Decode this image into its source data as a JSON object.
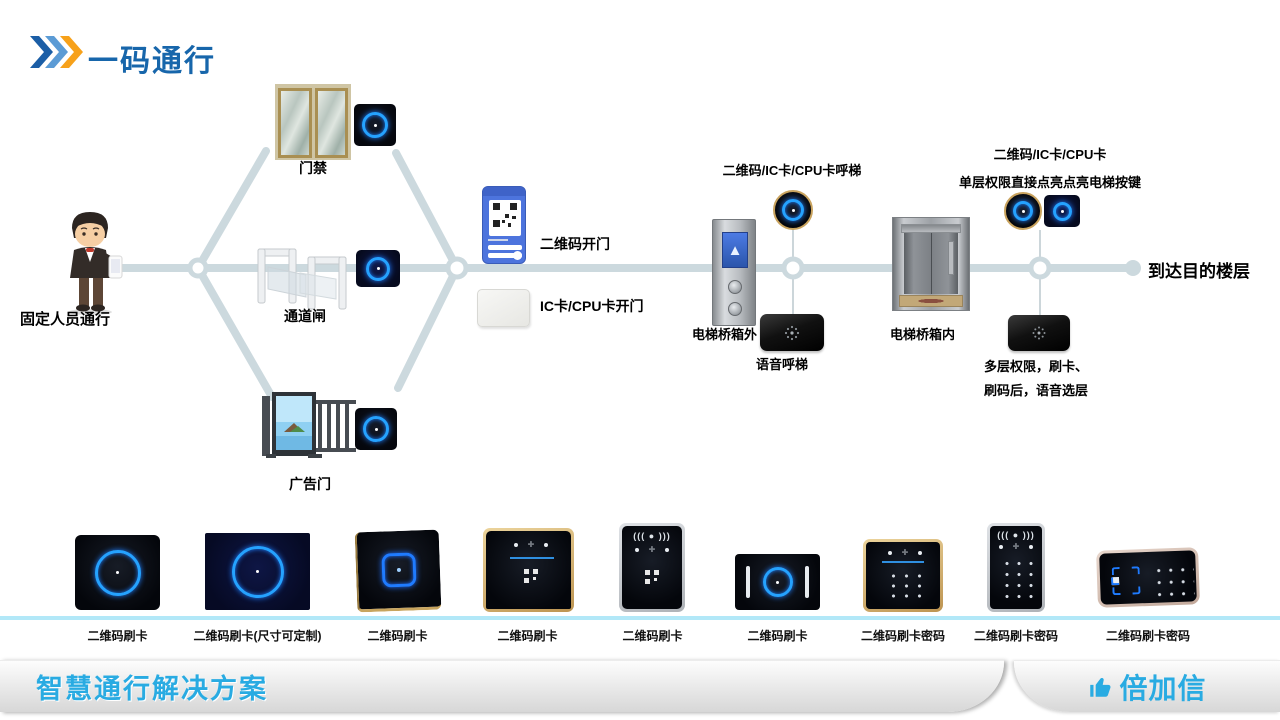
{
  "page": {
    "title": "一码通行",
    "footer_left": "智慧通行解决方案",
    "brand": "倍加信"
  },
  "flow": {
    "start_label": "固定人员通行",
    "gate_top": "门禁",
    "gate_mid": "通道闸",
    "gate_bottom": "广告门",
    "open_qr": "二维码开门",
    "open_ic": "IC卡/CPU卡开门",
    "call_label": "二维码/IC卡/CPU卡呼梯",
    "outside_label": "电梯桥箱外",
    "voice_call": "语音呼梯",
    "inside_top1": "二维码/IC卡/CPU卡",
    "inside_top2": "单层权限直接点亮点亮电梯按键",
    "inside_label": "电梯桥箱内",
    "voice_floor1": "多层权限，刷卡、",
    "voice_floor2": "刷码后，语音选层",
    "end_label": "到达目的楼层"
  },
  "products": [
    {
      "label": "二维码刷卡"
    },
    {
      "label": "二维码刷卡(尺寸可定制)"
    },
    {
      "label": "二维码刷卡"
    },
    {
      "label": "二维码刷卡"
    },
    {
      "label": "二维码刷卡"
    },
    {
      "label": "二维码刷卡"
    },
    {
      "label": "二维码刷卡密码"
    },
    {
      "label": "二维码刷卡密码"
    },
    {
      "label": "二维码刷卡密码"
    }
  ],
  "colors": {
    "title_blue": "#1766ab",
    "accent_cyan": "#29abe2",
    "connector": "#ccd9de",
    "divider_cyan": "#b2e8f8",
    "ring_blue": "#25a2ff",
    "chevron_dark": "#1b5ea6",
    "chevron_light": "#5b9bd5",
    "chevron_orange": "#f7a11a"
  }
}
